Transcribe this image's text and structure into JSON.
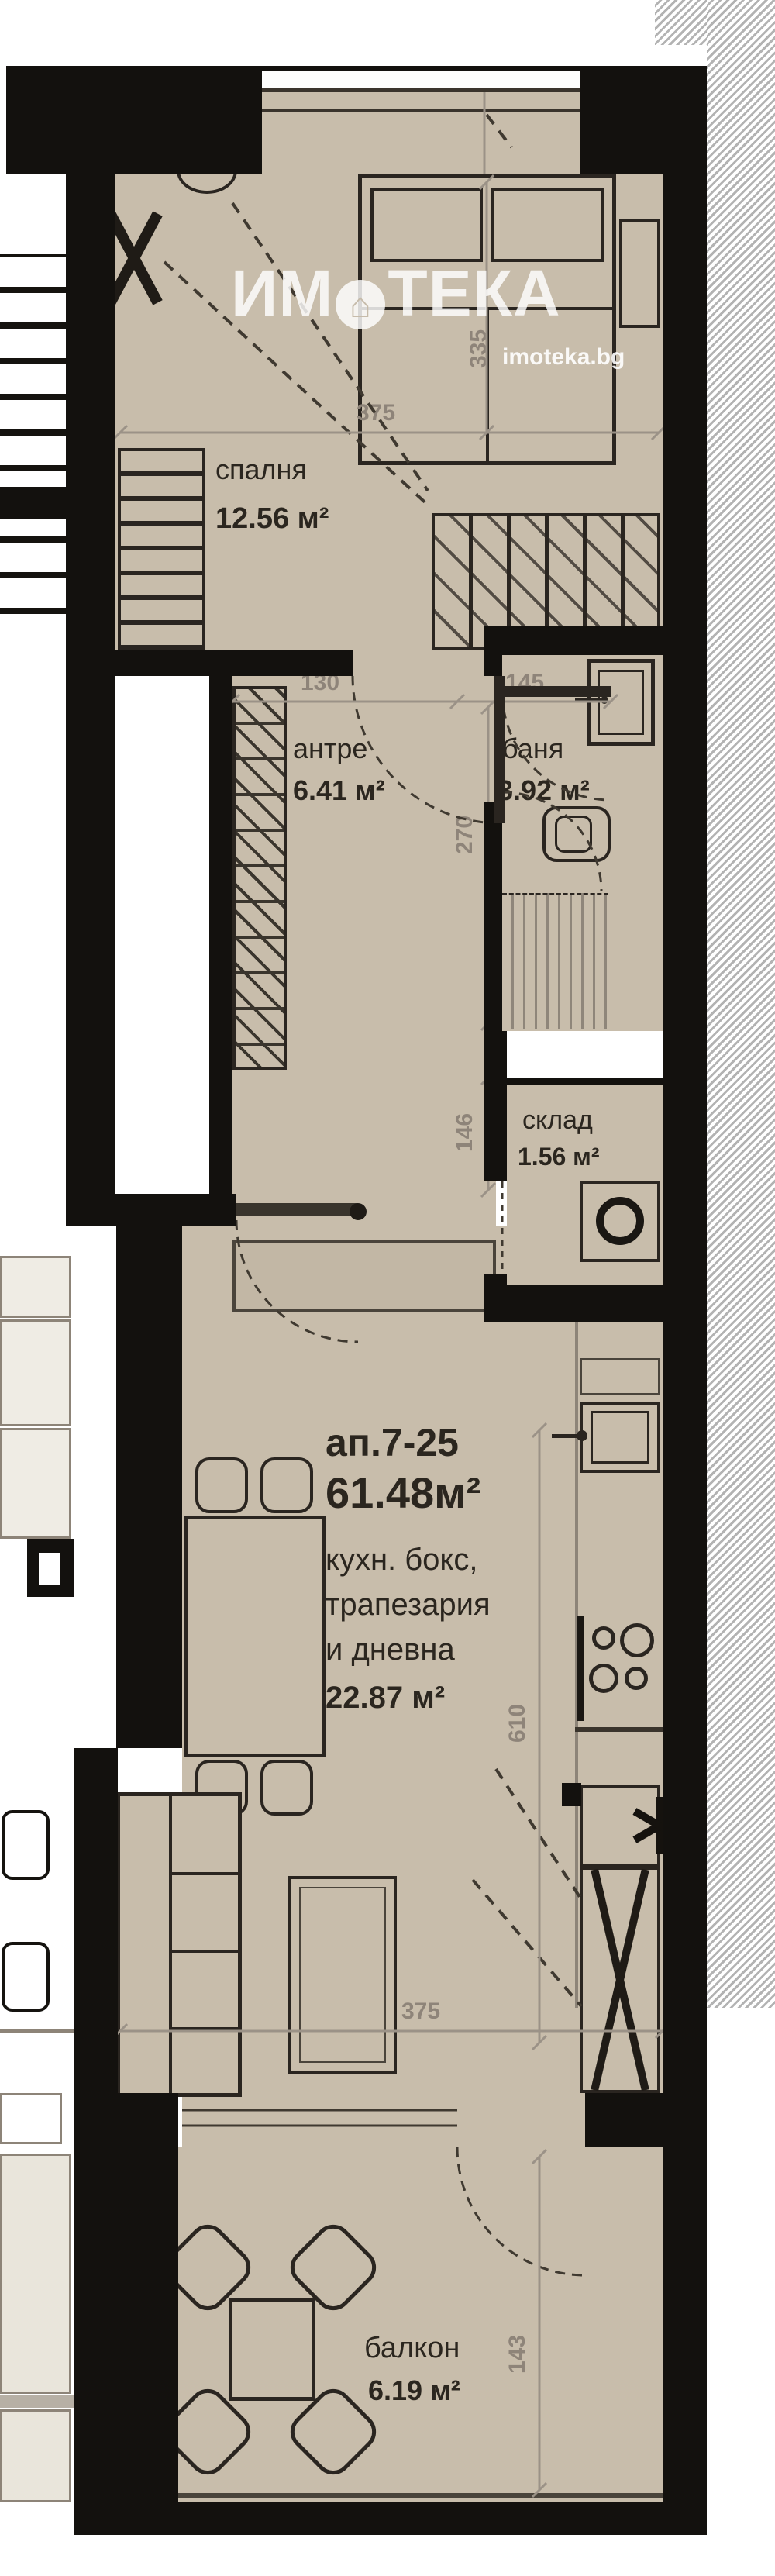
{
  "watermark": {
    "brand_part1": "ИМ",
    "brand_part2": "ТЕКА",
    "site": "imoteka.bg"
  },
  "icons": {
    "brand_o": "house-in-circle",
    "house_glyph": "⌂",
    "fridge": "snowflake-asterisk"
  },
  "unit": {
    "id": "ап.7-25",
    "total_area": "61.48м²"
  },
  "rooms": {
    "bedroom": {
      "name": "спалня",
      "area": "12.56 м²",
      "dims": {
        "width": "375",
        "length": "335"
      }
    },
    "hallway": {
      "name": "антре",
      "area": "6.41 м²",
      "dims": {
        "width": "130",
        "length": "146"
      }
    },
    "bathroom": {
      "name": "баня",
      "area": "3.92 м²",
      "dims": {
        "width": "145",
        "length": "270"
      }
    },
    "storage": {
      "name": "склад",
      "area": "1.56 м²"
    },
    "living": {
      "name_line1": "кухн. бокс,",
      "name_line2": "трапезария",
      "name_line3": "и дневна",
      "area": "22.87 м²",
      "dims": {
        "length": "610",
        "width": "375"
      }
    },
    "balcony": {
      "name": "балкон",
      "area": "6.19 м²",
      "dims": {
        "depth": "143"
      }
    }
  },
  "colors": {
    "floor": "#c8bdab",
    "wall": "#13110e",
    "dim_text": "#8e8479",
    "hatch_line": "#b3b3b3"
  }
}
